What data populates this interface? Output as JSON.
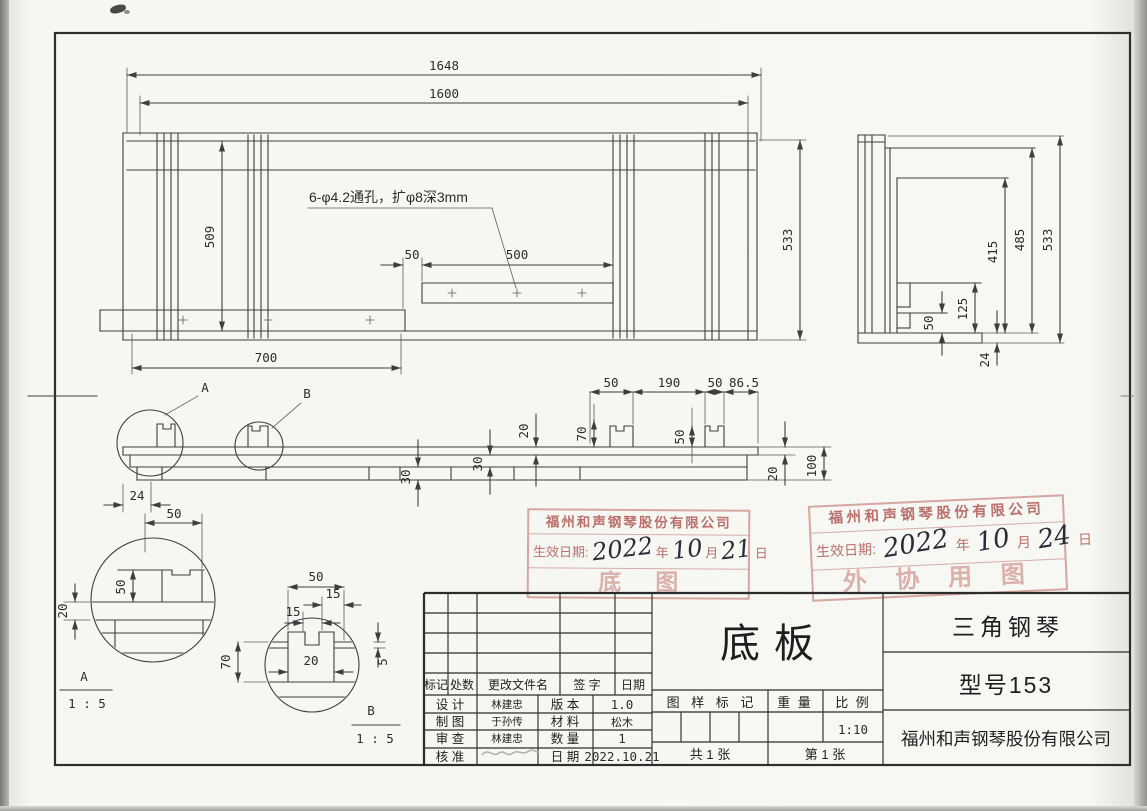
{
  "drawing": {
    "annotation": "6-φ4.2通孔，扩φ8深3mm",
    "front": {
      "total": "1648",
      "inner": "1600",
      "height": "509",
      "bottom": "700",
      "depth": "533",
      "offset": "50",
      "span": "500"
    },
    "side": {
      "h415": "415",
      "h485": "485",
      "h533": "533",
      "h125": "125",
      "h50": "50",
      "t24": "24"
    },
    "section": {
      "w50a": "50",
      "w190": "190",
      "w50b": "50",
      "w865": "86.5",
      "h70": "70",
      "h50": "50",
      "t20a": "20",
      "t30a": "30",
      "t30b": "30",
      "t20b": "20",
      "h100": "100",
      "viewA": "A",
      "viewB": "B"
    },
    "detailA": {
      "w24": "24",
      "w50": "50",
      "h50": "50",
      "t20": "20",
      "label": "A",
      "scale": "1 : 5"
    },
    "detailB": {
      "w50": "50",
      "w15a": "15",
      "w15b": "15",
      "w20": "20",
      "h70": "70",
      "t5": "5",
      "label": "B",
      "scale": "1 : 5"
    }
  },
  "stamps": {
    "left": {
      "company": "福州和声钢琴股份有限公司",
      "date_prefix": "生效日期:",
      "year_suffix": "年",
      "month_suffix": "月",
      "day_suffix": "日",
      "hand_year": "2022",
      "hand_month": "10",
      "hand_day": "21",
      "big_text": "底图"
    },
    "right": {
      "company": "福州和声钢琴股份有限公司",
      "date_prefix": "生效日期:",
      "year_suffix": "年",
      "month_suffix": "月",
      "day_suffix": "日",
      "hand_year": "2022",
      "hand_month": "10",
      "hand_day": "24",
      "big_text": "外 协 用 图"
    }
  },
  "title_block": {
    "rev": {
      "mark": "标记",
      "count": "处数",
      "file": "更改文件名",
      "sign": "签  字",
      "date": "日期"
    },
    "rows": [
      {
        "label": "设  计",
        "name": "林建忠",
        "prop": "版  本",
        "value": "1.0"
      },
      {
        "label": "制  图",
        "name": "于孙传",
        "prop": "材  料",
        "value": "松木"
      },
      {
        "label": "审  查",
        "name": "林建忠",
        "prop": "数  量",
        "value": "1"
      },
      {
        "label": "核  准",
        "name": "",
        "prop": "日  期",
        "value": "2022.10.21"
      }
    ],
    "part_name": "底板",
    "pattern_mark": "图 样 标 记",
    "weight": "重  量",
    "scale_label": "比  例",
    "scale_value": "1:10",
    "sheets_total": "共 1 张",
    "sheet_no": "第 1 张"
  },
  "name_block": {
    "product": "三角钢琴",
    "model": "型号153",
    "company": "福州和声钢琴股份有限公司"
  }
}
